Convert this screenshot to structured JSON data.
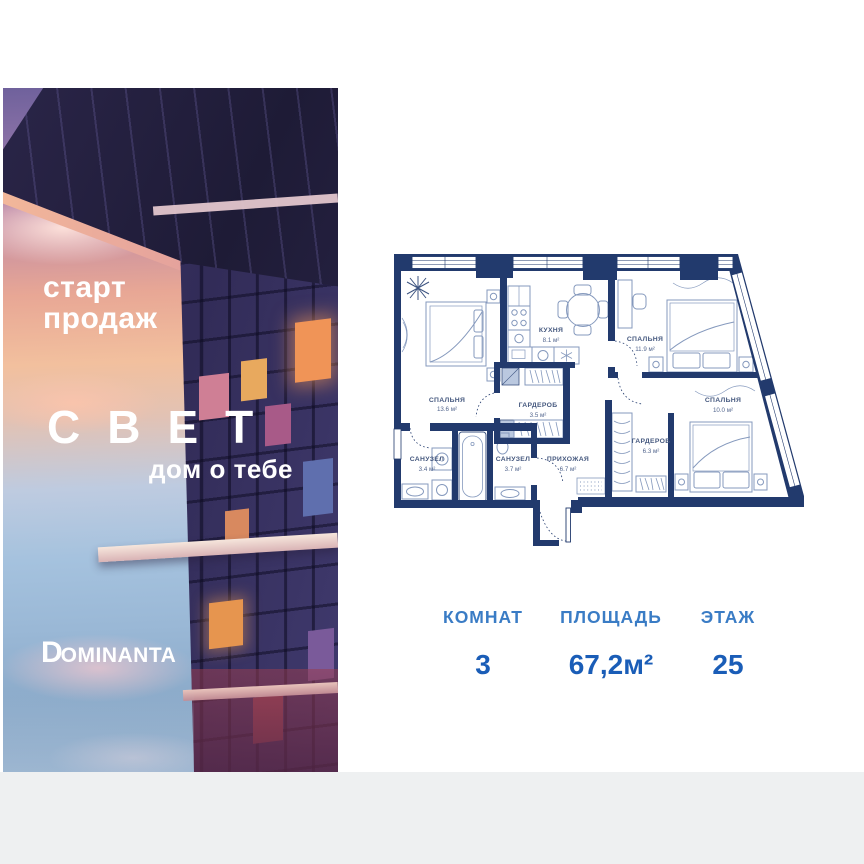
{
  "brand": {
    "start_line1": "старт",
    "start_line2": "продаж",
    "project_name": "СВЕТ",
    "tagline": "дом о тебе",
    "developer_logo_d": "D",
    "developer_logo_rest": "OMINANTA"
  },
  "floor_plan": {
    "rooms": [
      {
        "name": "СПАЛЬНЯ",
        "area": "13.6 м²"
      },
      {
        "name": "КУХНЯ",
        "area": "8.1 м²"
      },
      {
        "name": "СПАЛЬНЯ",
        "area": "11.9 м²"
      },
      {
        "name": "СПАЛЬНЯ",
        "area": "10.0 м²"
      },
      {
        "name": "ГАРДЕРОБ",
        "area": "3.5 м²"
      },
      {
        "name": "ГАРДЕРОБ",
        "area": "6.3 м²"
      },
      {
        "name": "САНУЗЕЛ",
        "area": "3.4 м²"
      },
      {
        "name": "САНУЗЕЛ",
        "area": "3.7 м²"
      },
      {
        "name": "ПРИХОЖАЯ",
        "area": "6.7 м²"
      }
    ]
  },
  "stats": [
    {
      "label": "КОМНАТ",
      "value": "3"
    },
    {
      "label": "ПЛОЩАДЬ",
      "value": "67,2м²"
    },
    {
      "label": "ЭТАЖ",
      "value": "25"
    }
  ],
  "colors": {
    "plan_walls": "#223a6d",
    "plan_furniture": "#8599bd",
    "stat_label": "#3a7cc5",
    "stat_value": "#1a5db7",
    "bottom_strip": "#eef0f1",
    "photo_text": "#ffffff"
  }
}
